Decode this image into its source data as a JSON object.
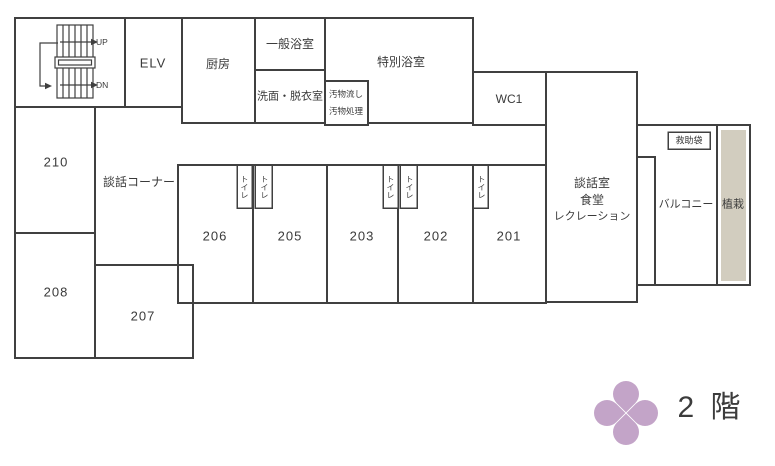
{
  "title": "2階 平面図",
  "labels": {
    "up": "UP",
    "dn": "DN",
    "elv": "ELV",
    "kitchen": "厨房",
    "general_bath": "一般浴室",
    "washroom": "洗面・脱衣室",
    "special_bath": "特別浴室",
    "waste_line1": "汚物流し",
    "waste_line2": "汚物処理",
    "wc1": "WC1",
    "talk_corner": "談話コーナー",
    "room210": "210",
    "room208": "208",
    "room207": "207",
    "room206": "206",
    "room205": "205",
    "room203": "203",
    "room202": "202",
    "room201": "201",
    "toilet": "トイレ",
    "lounge_line1": "談話室",
    "lounge_line2": "食堂",
    "lounge_line3": "レクレーション",
    "rescue_bag": "救助袋",
    "balcony": "バルコニー",
    "planting": "植栽",
    "floor": "2 階"
  },
  "colors": {
    "wall": "#404040",
    "text": "#3a3a3a",
    "planting_fill": "#d2cdbf",
    "flower": "#c3a4c8"
  }
}
